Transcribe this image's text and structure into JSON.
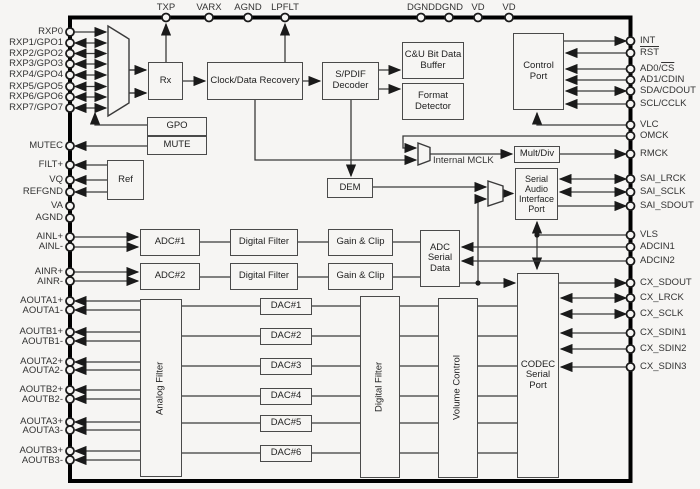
{
  "figure": {
    "description": "Audio CODEC / S-PDIF receiver block diagram",
    "colors": {
      "background": "#f6f5f3",
      "line": "#3a3a3a",
      "border": "#000000",
      "text": "#333333"
    }
  },
  "pins": {
    "top": [
      {
        "label": "TXP"
      },
      {
        "label": "VARX"
      },
      {
        "label": "AGND"
      },
      {
        "label": "LPFLT"
      },
      {
        "label": "DGND"
      },
      {
        "label": "DGND"
      },
      {
        "label": "VD"
      },
      {
        "label": "VD"
      }
    ],
    "left": [
      {
        "label": "RXP0"
      },
      {
        "label": "RXP1/GPO1"
      },
      {
        "label": "RXP2/GPO2"
      },
      {
        "label": "RXP3/GPO3"
      },
      {
        "label": "RXP4/GPO4"
      },
      {
        "label": "RXP5/GPO5"
      },
      {
        "label": "RXP6/GPO6"
      },
      {
        "label": "RXP7/GPO7"
      },
      {
        "label": "MUTEC"
      },
      {
        "label": "FILT+"
      },
      {
        "label": "VQ"
      },
      {
        "label": "REFGND"
      },
      {
        "label": "VA"
      },
      {
        "label": "AGND"
      },
      {
        "label": "AINL+"
      },
      {
        "label": "AINL-"
      },
      {
        "label": "AINR+"
      },
      {
        "label": "AINR-"
      },
      {
        "label": "AOUTA1+"
      },
      {
        "label": "AOUTA1-"
      },
      {
        "label": "AOUTB1+"
      },
      {
        "label": "AOUTB1-"
      },
      {
        "label": "AOUTA2+"
      },
      {
        "label": "AOUTA2-"
      },
      {
        "label": "AOUTB2+"
      },
      {
        "label": "AOUTB2-"
      },
      {
        "label": "AOUTA3+"
      },
      {
        "label": "AOUTA3-"
      },
      {
        "label": "AOUTB3+"
      },
      {
        "label": "AOUTB3-"
      }
    ],
    "right": [
      {
        "label": "INT"
      },
      {
        "label": "RST"
      },
      {
        "pre": "AD0/",
        "over": "CS"
      },
      {
        "label": "AD1/CDIN"
      },
      {
        "label": "SDA/CDOUT"
      },
      {
        "label": "SCL/CCLK"
      },
      {
        "label": "VLC"
      },
      {
        "label": "OMCK"
      },
      {
        "label": "RMCK"
      },
      {
        "label": "SAI_LRCK"
      },
      {
        "label": "SAI_SCLK"
      },
      {
        "label": "SAI_SDOUT"
      },
      {
        "label": "VLS"
      },
      {
        "label": "ADCIN1"
      },
      {
        "label": "ADCIN2"
      },
      {
        "label": "CX_SDOUT"
      },
      {
        "label": "CX_LRCK"
      },
      {
        "label": "CX_SCLK"
      },
      {
        "label": "CX_SDIN1"
      },
      {
        "label": "CX_SDIN2"
      },
      {
        "label": "CX_SDIN3"
      }
    ]
  },
  "blocks": {
    "rx": "Rx",
    "clock_data_recovery": "Clock/Data Recovery",
    "spdif_decoder": "S/PDIF Decoder",
    "cu_bit_data_buffer": "C&U Bit Data Buffer",
    "format_detector": "Format Detector",
    "control_port": "Control Port",
    "gpo": "GPO",
    "mute": "MUTE",
    "ref": "Ref",
    "internal_mclk": "Internal MCLK",
    "mult_div": "Mult/Div",
    "dem": "DEM",
    "serial_audio_interface_port": "Serial Audio Interface Port",
    "adc1": "ADC#1",
    "adc2": "ADC#2",
    "digital_filter_adc1": "Digital Filter",
    "digital_filter_adc2": "Digital Filter",
    "gain_clip_1": "Gain & Clip",
    "gain_clip_2": "Gain & Clip",
    "adc_serial_data": "ADC Serial Data",
    "analog_filter": "Analog Filter",
    "dac1": "DAC#1",
    "dac2": "DAC#2",
    "dac3": "DAC#3",
    "dac4": "DAC#4",
    "dac5": "DAC#5",
    "dac6": "DAC#6",
    "digital_filter_dac": "Digital Filter",
    "volume_control": "Volume Control",
    "codec_serial_port": "CODEC Serial Port"
  }
}
